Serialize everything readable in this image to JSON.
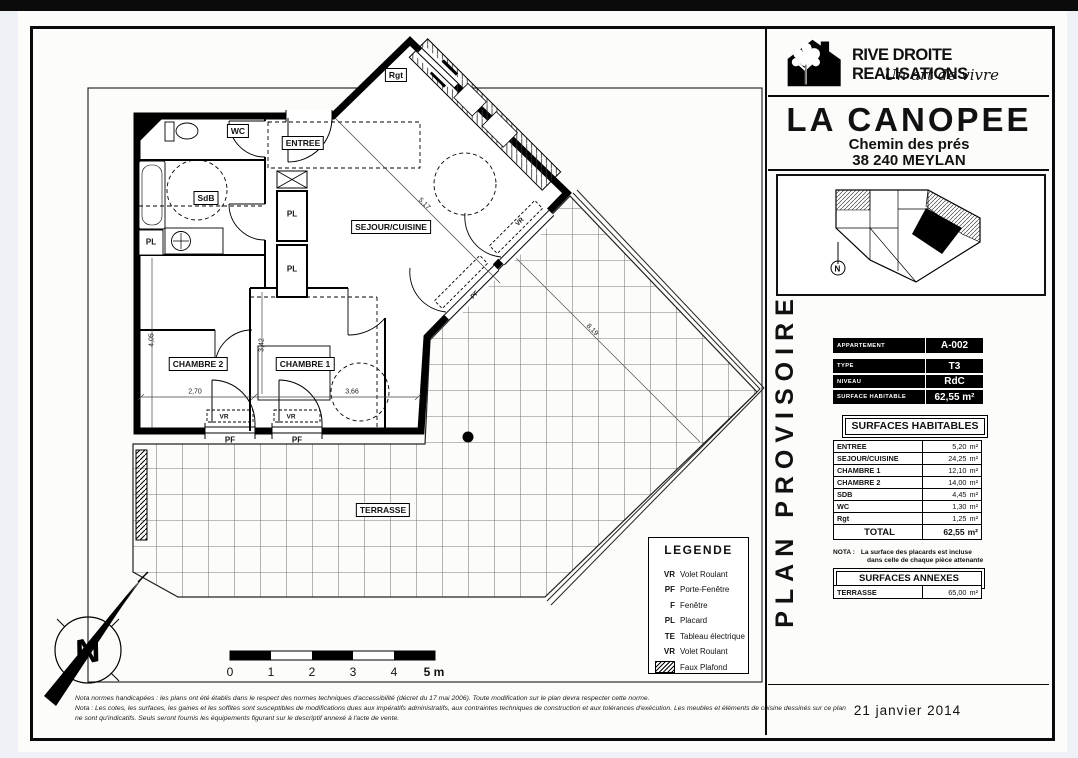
{
  "company": {
    "name": "RIVE DROITE REALISATIONS",
    "tagline": "Un art de vivre"
  },
  "project": {
    "name": "LA CANOPEE",
    "address1": "Chemin des prés",
    "address2": "38 240 MEYLAN"
  },
  "stamp": "PLAN PROVISOIRE",
  "date": "21 janvier 2014",
  "apartment_info": {
    "rows": [
      {
        "label": "APPARTEMENT",
        "value": "A-002"
      },
      {
        "label": "TYPE",
        "value": "T3"
      },
      {
        "label": "NIVEAU",
        "value": "RdC"
      },
      {
        "label": "SURFACE HABITABLE",
        "value": "62,55 m²"
      }
    ]
  },
  "surfaces_habitables": {
    "title": "SURFACES HABITABLES",
    "rows": [
      {
        "label": "ENTREE",
        "value": "5,20",
        "unit": "m²"
      },
      {
        "label": "SEJOUR/CUISINE",
        "value": "24,25",
        "unit": "m²"
      },
      {
        "label": "CHAMBRE 1",
        "value": "12,10",
        "unit": "m²"
      },
      {
        "label": "CHAMBRE 2",
        "value": "14,00",
        "unit": "m²"
      },
      {
        "label": "SDB",
        "value": "4,45",
        "unit": "m²"
      },
      {
        "label": "WC",
        "value": "1,30",
        "unit": "m²"
      },
      {
        "label": "Rgt",
        "value": "1,25",
        "unit": "m²"
      }
    ],
    "total": {
      "label": "TOTAL",
      "value": "62,55",
      "unit": "m²"
    },
    "nota_label": "NOTA :",
    "nota_line1": "La surface des placards est incluse",
    "nota_line2": "dans celle de chaque pièce attenante"
  },
  "surfaces_annexes": {
    "title": "SURFACES ANNEXES",
    "rows": [
      {
        "label": "TERRASSE",
        "value": "65,00",
        "unit": "m²"
      }
    ]
  },
  "legend": {
    "title": "LEGENDE",
    "items": [
      {
        "code": "VR",
        "label": "Volet Roulant"
      },
      {
        "code": "PF",
        "label": "Porte-Fenêtre"
      },
      {
        "code": "F",
        "label": "Fenêtre"
      },
      {
        "code": "PL",
        "label": "Placard"
      },
      {
        "code": "TE",
        "label": "Tableau électrique"
      },
      {
        "code": "VR",
        "label": "Volet Roulant"
      }
    ],
    "hatch_label": "Faux Plafond"
  },
  "plan": {
    "rooms": {
      "wc": "WC",
      "entree": "ENTREE",
      "sdb": "SdB",
      "rgt": "Rgt",
      "sejour": "SEJOUR/CUISINE",
      "chambre2": "CHAMBRE 2",
      "chambre1": "CHAMBRE 1",
      "terrasse": "TERRASSE",
      "pl": "PL",
      "pf": "PF",
      "vr": "VR"
    },
    "dims": {
      "d1": "2,70",
      "d2": "3,66",
      "d3": "4,05",
      "d4": "3,42",
      "d5": "5,17",
      "d6": "8,19"
    },
    "north": "N",
    "scale": {
      "t0": "0",
      "t1": "1",
      "t2": "2",
      "t3": "3",
      "t4": "4",
      "t5": "5 m"
    }
  },
  "notes": {
    "line1": "Nota normes handicapées : les plans ont été établis dans le respect des normes techniques d'accessibilité (décret du 17 mai 2006). Toute modification sur le plan devra respecter cette norme.",
    "line2": "Nota : Les cotes, les surfaces, les gaines et les soffites sont susceptibles de modifications dues aux impératifs administratifs, aux contraintes techniques de construction et aux tolérances d'exécution. Les meubles et éléments de cuisine dessinés sur ce plan",
    "line3": "ne sont qu'indicatifs. Seuls seront fournis les équipements figurant sur le descriptif annexé à l'acte de vente."
  }
}
